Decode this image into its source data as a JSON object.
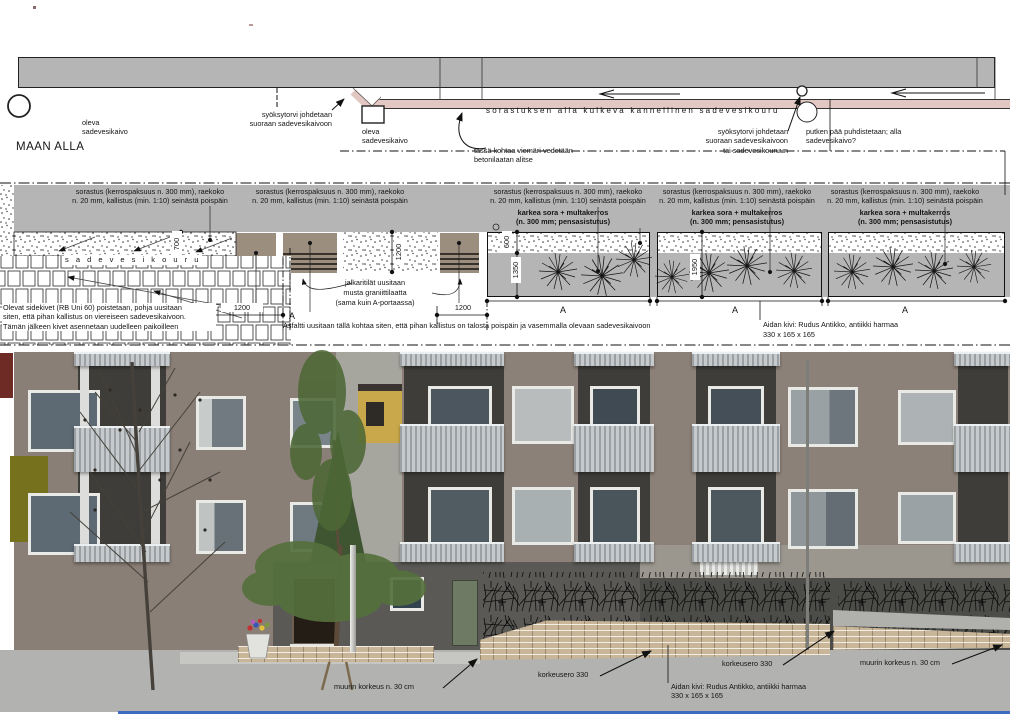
{
  "colors": {
    "band_gray": "#b5b5b5",
    "pipe_pink": "#e3c7c2",
    "slab_taupe": "#9c8e7f",
    "brick_tan": "#c9b698",
    "olive_accent": "#75711c",
    "blue_rule": "#3b6cc0",
    "facade": "#8a7f76",
    "ground_recess": "#5a5956",
    "asphalt": "#b2b2b0"
  },
  "top_plan": {
    "maan_alla": "MAAN ALLA",
    "existing_drain_left": "oleva\nsadevesikaivo",
    "existing_drain_mid": "oleva\nsadevesikaivo",
    "downpipe_left_note": "syöksytorvi johdetaan\nsuoraan sadevesikaivoon",
    "channel_title": "sorastuksen alla kulkeva kannellinen sadevesikouru",
    "downpipe_right_note": "syöksytorvi johdetaan\nsuoraan sadevesikaivoon\ntai sadevesikouruun",
    "pipe_end_note": "putken pää puhdistetaan; alla\nsadevesikaivo?",
    "sewer_note": "tässä kohtaa viemäri vedetään\nbetonilaatan alitse"
  },
  "mid_section": {
    "sorastus_note": "sorastus (kerrospaksuus n. 300 mm), raekoko\nn. 20 mm, kallistus (min. 1:10) seinästä poispäin",
    "karkea_note": "karkea sora + multakerros\n(n. 300 mm; pensasistutus)",
    "sadevesikouru_label": "s a d e v e s i k o u r u",
    "pavers_note": "Olevat sidekivet (RB Uni 60) poistetaan, pohja uusitaan\nsiten, että pihan kallistus on viereiseen sadevesikaivoon.\nTämän jälkeen kivet asennetaan uudelleen paikoilleen",
    "grille_note": "jalkaritilät uusitaan",
    "granite_note": "musta graniittilaatta",
    "granite_note2": "(sama kuin A-portaassa)",
    "asphalt_note": "Asfaltti uusitaan tällä kohtaa siten, että pihan kallistus on talosta poispäin ja vasemmalla olevaan sadevesikaivoon",
    "fence_stone_note": "Aidan kivi: Rudus Antikko, antiikki harmaa",
    "fence_stone_size": "330 x 165 x 165",
    "dims": {
      "d700": "700",
      "d1200": "1200",
      "d600": "600",
      "d1350": "1350",
      "d1950": "1950"
    },
    "section_label": "A"
  },
  "photo": {
    "wall_height_left": "muurin korkeus n. 30 cm",
    "level_diff_left": "korkeusero 330",
    "level_diff_right": "korkeusero 330",
    "wall_height_right": "muurin korkeus n. 30 cm",
    "fence_stone_note": "Aidan kivi: Rudus Antikko, antiikki harmaa\n330 x 165 x 165"
  }
}
